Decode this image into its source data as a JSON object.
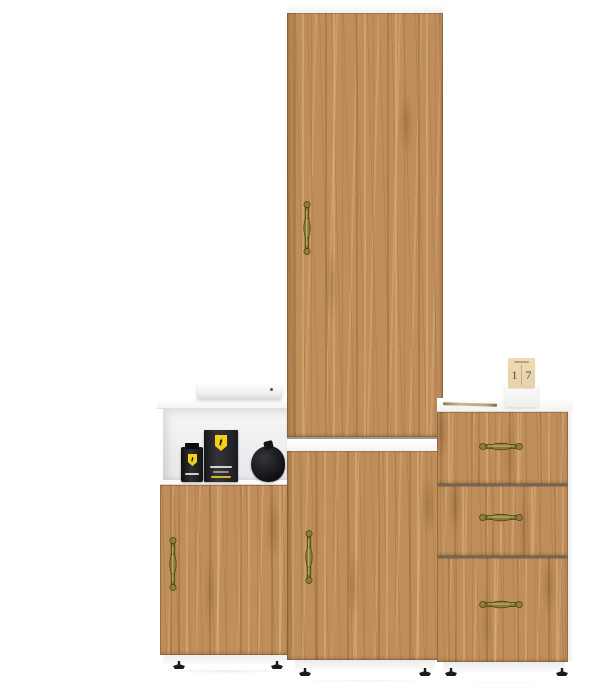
{
  "meta": {
    "type": "product-photo",
    "subject": "Three-piece oak and white furniture set: tall wardrobe cabinet, low cabinet with open shelf, and three-drawer chest on a white background"
  },
  "colors": {
    "background": "#ffffff",
    "wood_base": "#c08e5a",
    "wood_grain_dark": "#8b5e34",
    "wood_grain_light": "#e0ba84",
    "frame_white": "#ffffff",
    "panel_shadow": "#ececec",
    "shelf_interior": "#e7e7ea",
    "drawer_gap": "#6e675e",
    "handle_brass": "#8a7b36",
    "handle_brass_dark": "#463c16",
    "handle_brass_light": "#cdbd6a",
    "feet": "#1b1b1c",
    "ferrari_yellow": "#f2cf1d",
    "prop_black": "#17171a",
    "calendar_paper": "#eedcb6",
    "calendar_base": "#fdfdfd",
    "calendar_digits": "#564d41"
  },
  "units": {
    "tall_cabinet": {
      "name": "Tall wardrobe cabinet",
      "sections": [
        "white top edge",
        "upper tall door",
        "white mid shelf band",
        "lower door",
        "white plinth with black feet"
      ],
      "handle_style": "antique brass spindle, vertical"
    },
    "left_cabinet": {
      "name": "Low cabinet with open shelf niche",
      "sections": [
        "white top surface",
        "open shelf niche",
        "hinged wood door",
        "white plinth with black feet"
      ],
      "handle_style": "antique brass spindle, vertical"
    },
    "drawer_chest": {
      "name": "Three-drawer chest",
      "drawer_count": 3,
      "handle_style": "antique brass spindle, horizontal"
    }
  },
  "props": {
    "media_box": "flat white media player box with small dark indicator dot",
    "perfume_bottle": "black cologne bottle with yellow shield badge",
    "perfume_box": "black cologne box with yellow shield badge and fine white text",
    "pouch": "round black pouch",
    "pen": "slim wooden pen lying on chest top",
    "calendar": {
      "type": "desk flip calendar on white base",
      "day_digit_left": "1",
      "day_digit_right": "7"
    }
  }
}
